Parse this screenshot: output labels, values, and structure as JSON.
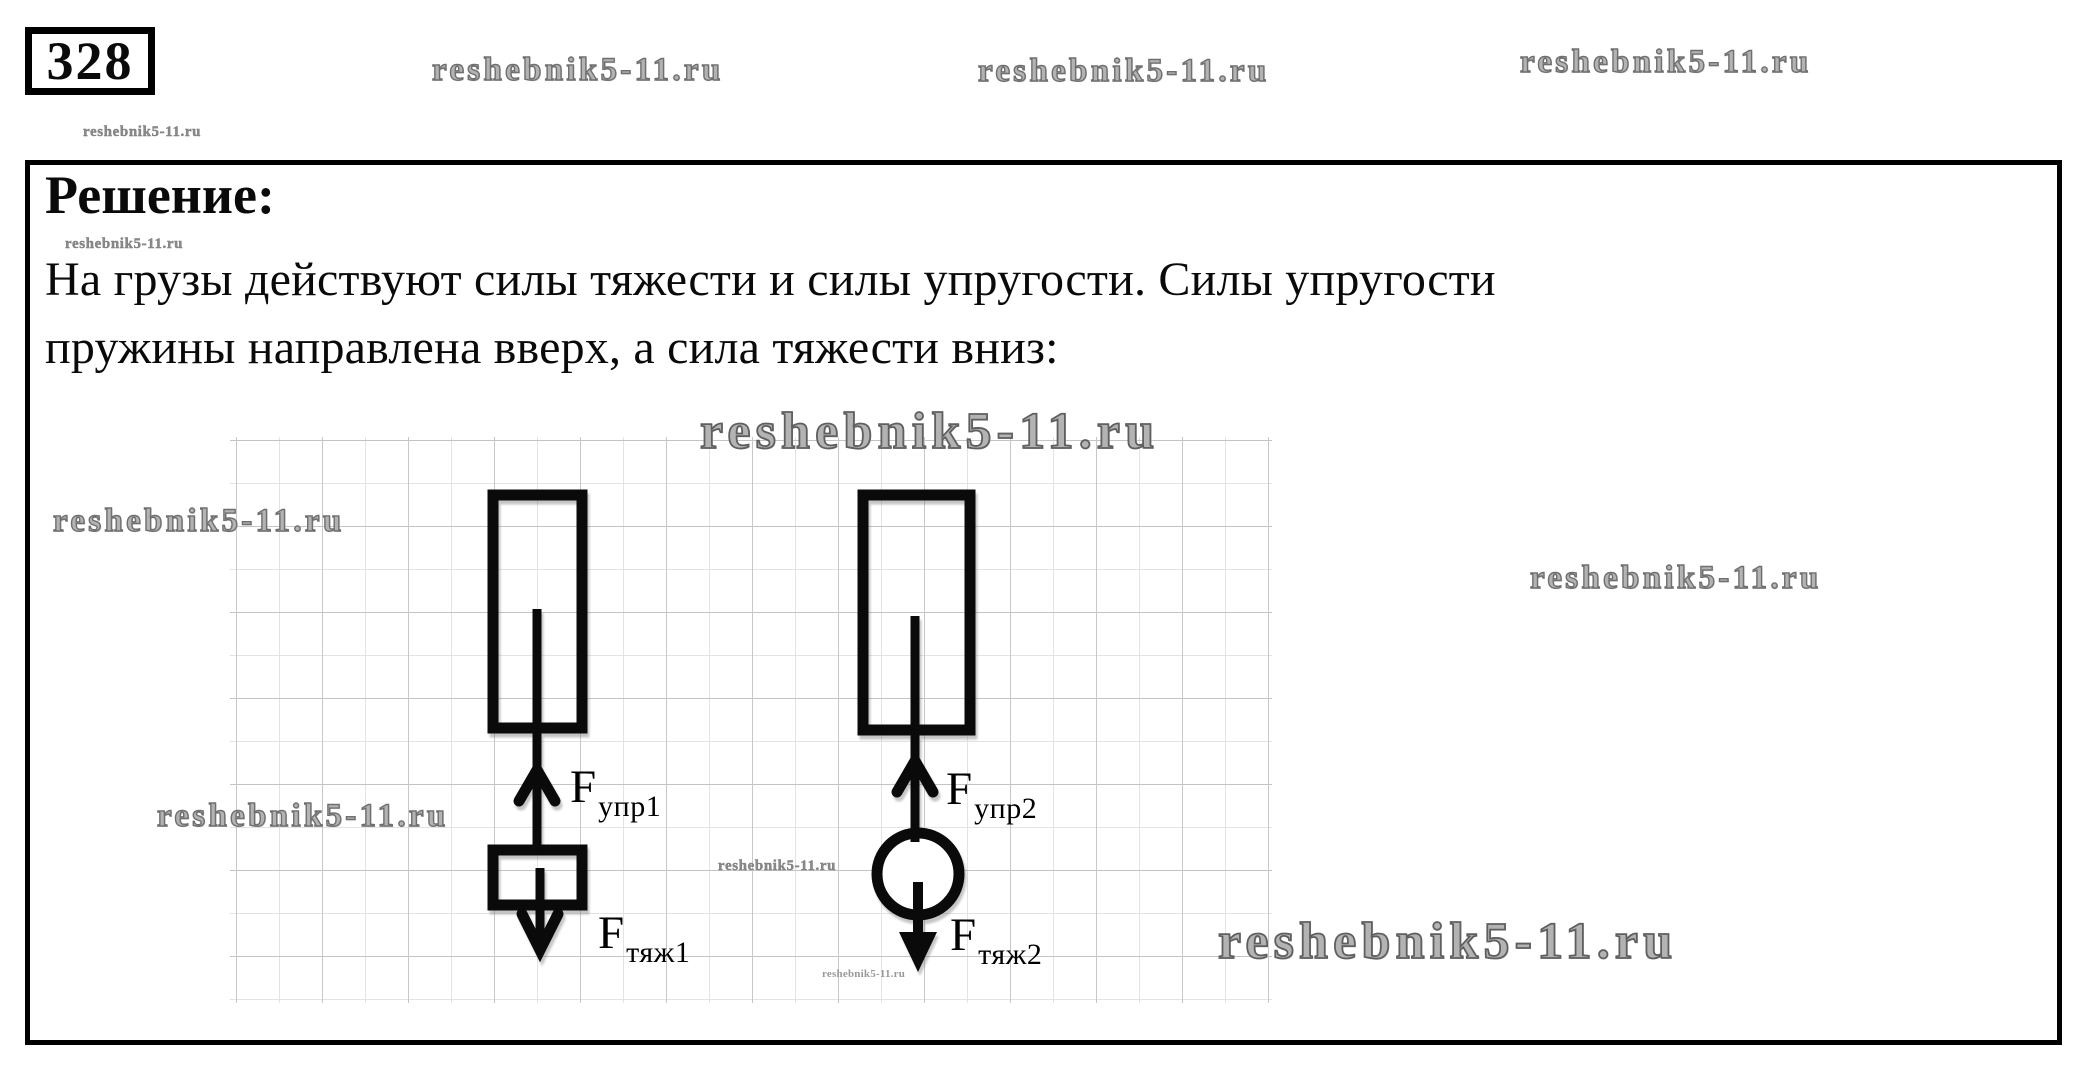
{
  "watermark": "reshebnik5-11.ru",
  "problem_number": "328",
  "solution": {
    "heading": "Решение:",
    "text_line1": "На грузы действуют силы тяжести и силы упругости. Силы упругости",
    "text_line2": "пружины направлена вверх, а сила тяжести вниз:"
  },
  "diagram": {
    "force_up_left": {
      "symbol": "F",
      "subscript": "упр1"
    },
    "force_down_left": {
      "symbol": "F",
      "subscript": "тяж1"
    },
    "force_up_right": {
      "symbol": "F",
      "subscript": "упр2"
    },
    "force_down_right": {
      "symbol": "F",
      "subscript": "тяж2"
    }
  },
  "colors": {
    "ink": "#0a0a0a",
    "watermark_gray": "#8a8a8a",
    "grid_gray": "#c2c2c2"
  }
}
